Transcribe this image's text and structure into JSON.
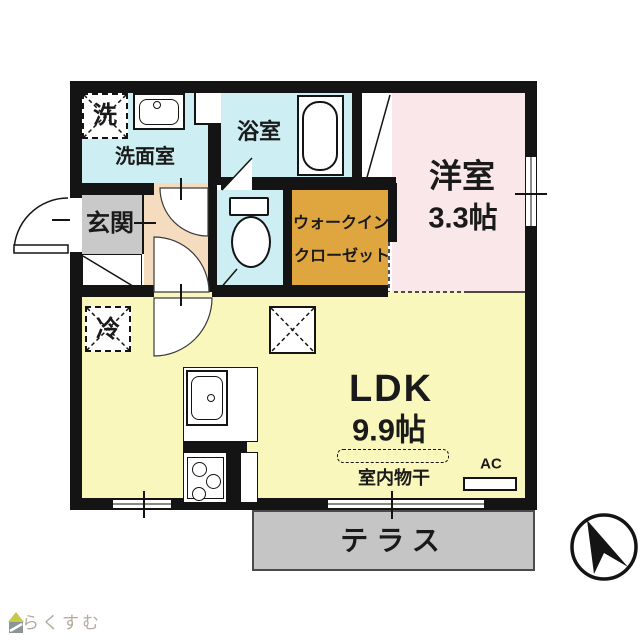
{
  "rooms": {
    "washroom": "洗面室",
    "bathroom": "浴室",
    "entrance": "玄関",
    "walk_in_closet_line1": "ウォークイン",
    "walk_in_closet_line2": "クローゼット",
    "western_room": "洋室",
    "western_room_size": "3.3帖",
    "ldk": "LDK",
    "ldk_size": "9.9帖",
    "terrace": "テラス"
  },
  "symbols": {
    "washer": "洗",
    "refrigerator": "冷",
    "indoor_drying": "室内物干",
    "air_conditioner": "AC"
  },
  "logo": {
    "text": "らくすむ"
  },
  "colors": {
    "wet_area_cyan": "#cdeef2",
    "western_room_pink": "#f9e7ea",
    "ldk_yellow": "#faf7bd",
    "closet_orange": "#dfa640",
    "entrance_gray": "#c9c9c9",
    "terrace_gray": "#c5c5c5",
    "hall_peach": "#f6dcbe",
    "wall_black": "#141414",
    "logo_roof_green": "#c6ca4b",
    "logo_text_gray": "#b3aa9c"
  }
}
